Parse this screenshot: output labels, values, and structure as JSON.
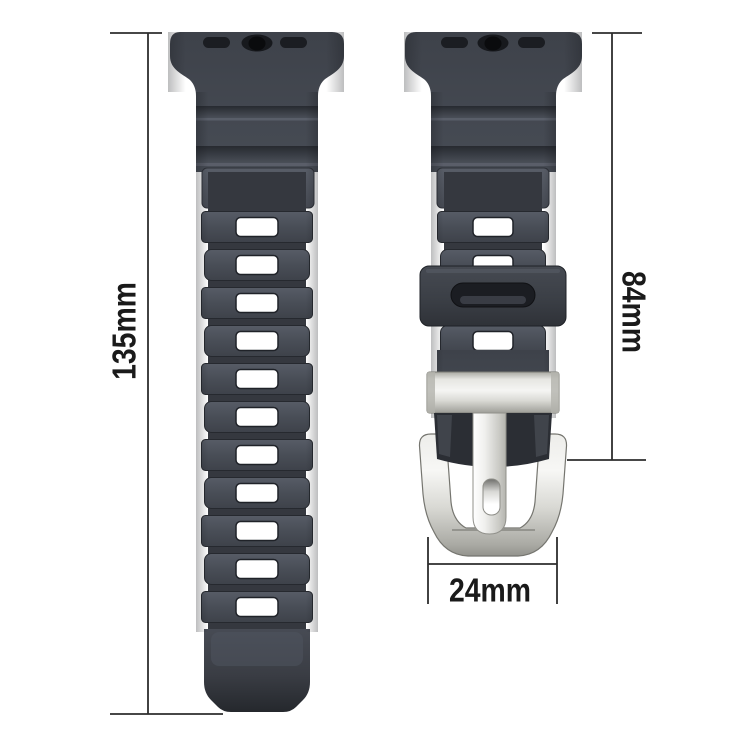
{
  "page": {
    "background": "#ffffff",
    "description": "Dimension diagram of a dark grey rubber sport watch band with silver buckle"
  },
  "dimensions": {
    "left_strap_length": "135mm",
    "right_strap_length": "84mm",
    "buckle_width": "24mm"
  },
  "structure": {
    "left_strap": {
      "adjustment_holes": 11
    },
    "right_strap": {
      "visible_holes": 4
    }
  },
  "colors": {
    "background": "#ffffff",
    "strap": "#464b54",
    "strap-shadow": "#2c2f35",
    "slot-dark": "#1b1d22",
    "hole": "#ffffff",
    "metal-light": "#f2f2f0",
    "metal-dark": "#9b9b95",
    "dim-line": "#2d2d2d",
    "label-text": "#1a1a1a"
  }
}
